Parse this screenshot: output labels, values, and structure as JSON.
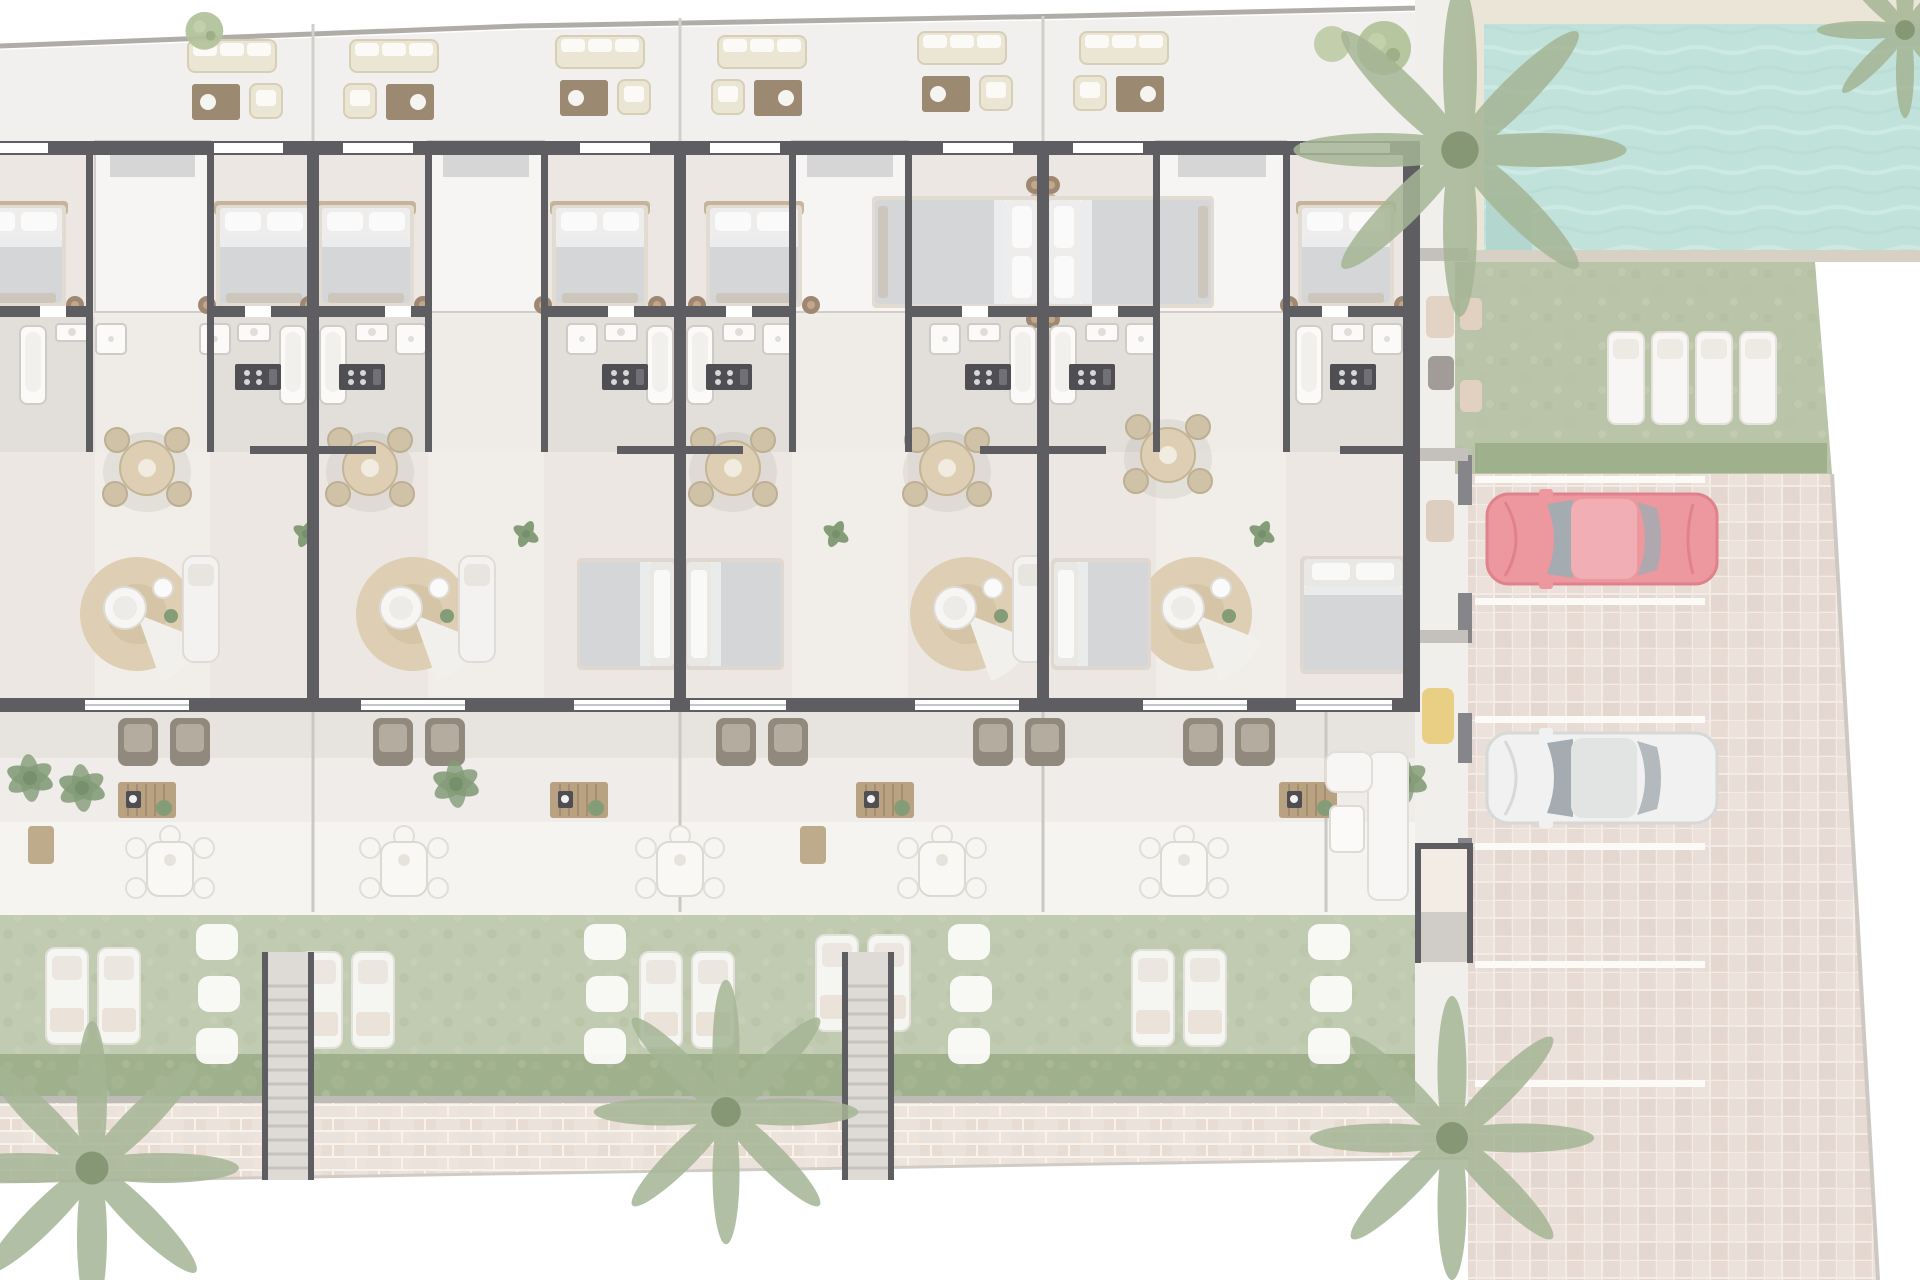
{
  "title": "Residential development ground-floor site plan (top-down architectural render)",
  "palette": {
    "bg": "#ffffff",
    "roof": "#efeeec",
    "floor": "#e9e3dd",
    "bath": "#ddd8d3",
    "well": "#f5f4f2",
    "wall": "#3f3f45",
    "boundary": "#a19e99",
    "canopy": "#cfced0",
    "terr1": "#e3dfda",
    "terr2": "#ece9e5",
    "terr3": "#f3f2ef",
    "lawn": "#b6c1a3",
    "lawn2": "#adb999",
    "hedge": "#8da177",
    "pool": "#b5dcd5",
    "deck": "#e8e0d0",
    "curb": "#cfc7ba",
    "strip": "#edece9",
    "pave": "#e5d8d0",
    "brick": "#e8ddd4",
    "wood": "#ab9169",
    "wood-dk": "#8a7356",
    "beige": "#e8e0cb",
    "white-furn": "#f4f3f1",
    "gray-furn": "#cdced1",
    "rug": "#d8c5a5",
    "rug2": "#cdb995",
    "pouf": "#8d7157",
    "taupe": "#7e7366",
    "plant": "#6d8a5f",
    "palm": "#94a881",
    "appliance": "#2e2e33",
    "fence": "#b3aea8",
    "red-car": "#ea848d",
    "red-car-dark": "#d96b76",
    "red-car-roof": "#efa0a7",
    "white-car": "#eeefee",
    "car-glass": "#939ba3",
    "yellow": "#e5c66d"
  },
  "scene": {
    "building": {
      "residential_units": 8,
      "mirrored_unit_pairs": 4,
      "top_bedrooms_with_double_beds": 7,
      "secondary_bedrooms": 4,
      "bathrooms": 8,
      "kitchen_counters": 7,
      "round_dining_sets": 5,
      "living_rug_lounges": 4,
      "light_wells": 4
    },
    "roof_terrace": {
      "outdoor_lounge_sets": 6,
      "potted_trees": 3
    },
    "gardens": {
      "private_gardens": 5,
      "terrace_armchair_pairs": 5,
      "bbq_sideboards": 4,
      "patio_dining_sets": 5,
      "sun_lounger_pairs": 5,
      "white_shrub_rows": 4,
      "garden_stairs": 2,
      "palm_trees": 4
    },
    "amenities": {
      "swimming_pool": 1,
      "pool_lawn_loungers": 4,
      "parking_spaces": 6,
      "parked_cars": [
        {
          "color_name": "red"
        },
        {
          "color_name": "white"
        }
      ]
    }
  }
}
